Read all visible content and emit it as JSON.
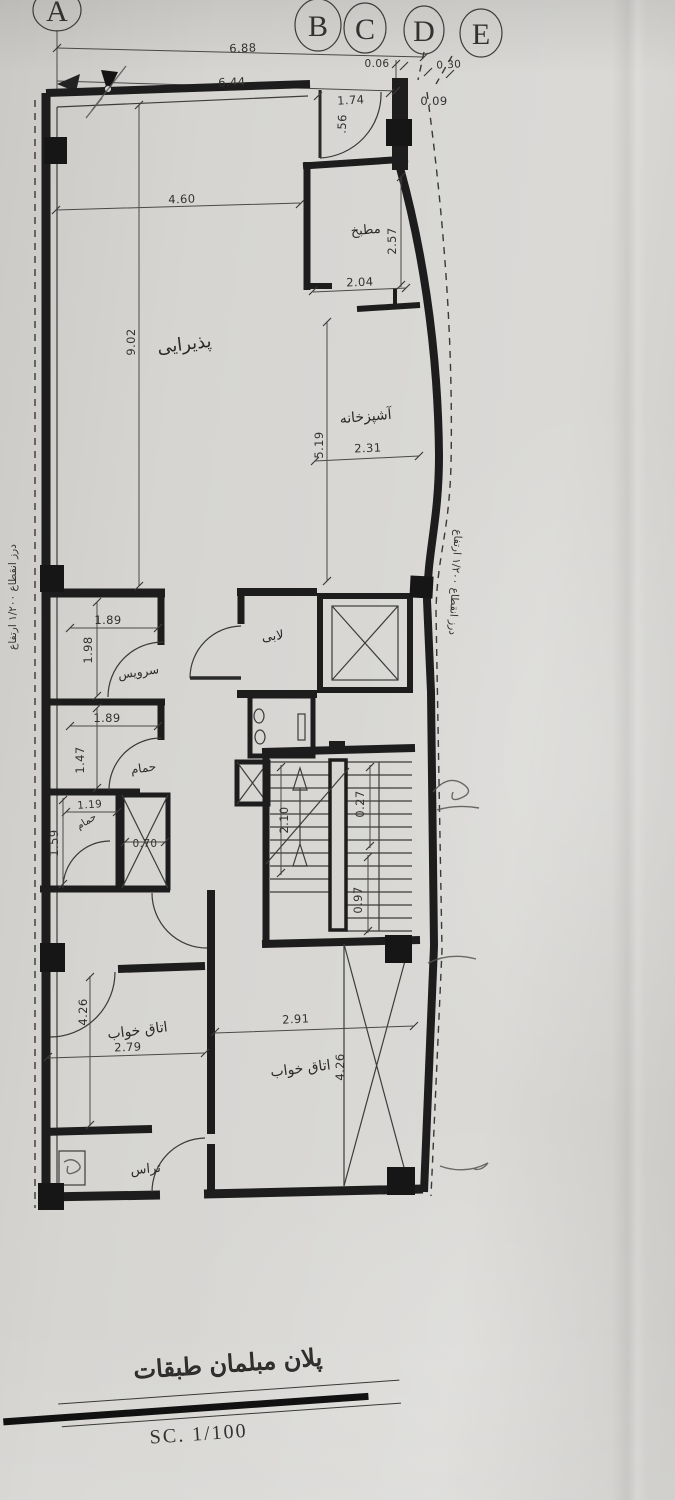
{
  "document": {
    "title": "پلان مبلمان طبقات",
    "scale": "SC.   1/100"
  },
  "grid": {
    "labels": [
      "A",
      "B",
      "C",
      "D",
      "E"
    ]
  },
  "notes": {
    "left_joint": "درز انقطاع ۱/۲۰۰ ارتفاع",
    "right_joint": "درز انقطاع ۱/۲۰۰ ارتفاع"
  },
  "rooms": {
    "reception": "پذیرایی",
    "pantry": "مطبخ",
    "kitchen": "آشپزخانه",
    "lobby": "لابی",
    "wc": "سرویس",
    "bath": "حمام",
    "bath2": "حمام",
    "bedroom_left": "اتاق خواب",
    "bedroom_right": "اتاق خواب",
    "terrace": "تراس"
  },
  "dims": {
    "overall_a_d": "6.88",
    "overall_a_c": "6.44",
    "gap_cd": "0.06",
    "gap_de": "0.30",
    "entry_opening": "1.74",
    "entry_offset": "0.09",
    "entry_side": ".56",
    "reception_width": "4.60",
    "reception_length": "9.02",
    "pantry_depth": "2.57",
    "pantry_width": "2.04",
    "kitchen_length": "5.19",
    "kitchen_width": "2.31",
    "wc_width": "1.89",
    "wc_depth": "1.98",
    "bath_width": "1.89",
    "bath_depth": "1.47",
    "bath2_width": "1.19",
    "bath2_depth": "1.59",
    "shaft_width": "0.70",
    "stair_flight": "2.10",
    "stair_tread": "0.27",
    "stair_landing": "0.97",
    "bedl_length": "4.26",
    "bedl_width": "2.79",
    "bedr_width": "2.91",
    "bedr_length": "4.26"
  }
}
